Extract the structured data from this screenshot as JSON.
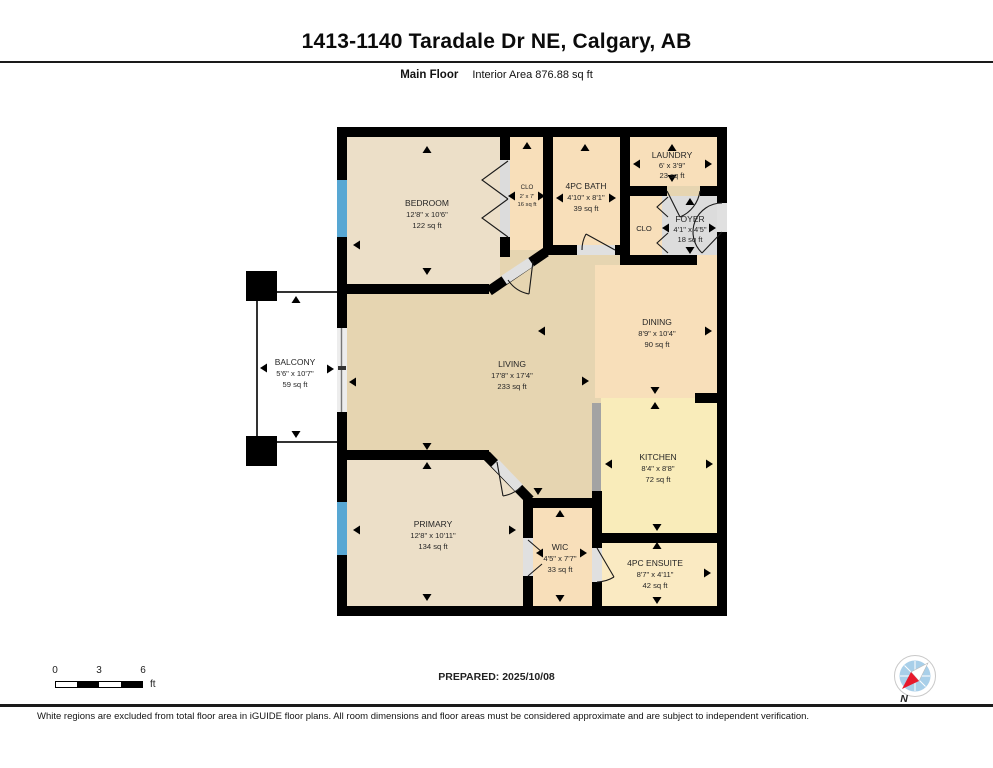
{
  "header": {
    "title": "1413-1140 Taradale Dr NE, Calgary, AB",
    "floor_label": "Main Floor",
    "area_label": "Interior Area 876.88 sq ft"
  },
  "rooms": {
    "bedroom": {
      "name": "BEDROOM",
      "dims": "12'8\" x 10'6\"",
      "area": "122 sq ft"
    },
    "clo_bedroom": {
      "name": "CLO",
      "dims": "2' x 7'",
      "area": "16 sq ft"
    },
    "bath": {
      "name": "4PC BATH",
      "dims": "4'10\" x 8'1\"",
      "area": "39 sq ft"
    },
    "laundry": {
      "name": "LAUNDRY",
      "dims": "6' x 3'9\"",
      "area": "23 sq ft"
    },
    "foyer": {
      "name": "FOYER",
      "dims": "4'1\" x 4'5\"",
      "area": "18 sq ft"
    },
    "clo_foyer": {
      "name": "CLO"
    },
    "dining": {
      "name": "DINING",
      "dims": "8'9\" x 10'4\"",
      "area": "90 sq ft"
    },
    "living": {
      "name": "LIVING",
      "dims": "17'8\" x 17'4\"",
      "area": "233 sq ft"
    },
    "kitchen": {
      "name": "KITCHEN",
      "dims": "8'4\" x 8'8\"",
      "area": "72 sq ft"
    },
    "primary": {
      "name": "PRIMARY",
      "dims": "12'8\" x 10'11\"",
      "area": "134 sq ft"
    },
    "wic": {
      "name": "WIC",
      "dims": "4'5\" x 7'7\"",
      "area": "33 sq ft"
    },
    "ensuite": {
      "name": "4PC ENSUITE",
      "dims": "8'7\" x 4'11\"",
      "area": "42 sq ft"
    },
    "balcony": {
      "name": "BALCONY",
      "dims": "5'6\" x 10'7\"",
      "area": "59 sq ft"
    }
  },
  "scale_bar": {
    "tick0": "0",
    "tick1": "3",
    "tick2": "6",
    "unit": "ft"
  },
  "prepared_label": "PREPARED: 2025/10/08",
  "compass": {
    "north_label": "N"
  },
  "footer_disclaimer": "White regions are excluded from total floor area in iGUIDE floor plans. All room dimensions and floor areas must be considered approximate and are subject to independent verification.",
  "colors": {
    "wall": "#000000",
    "window": "#58a7d3",
    "floor_living": "#e6d5b1",
    "floor_bedroom": "#ecdfc8",
    "floor_peach": "#f8dfba",
    "floor_kitchen": "#f9ecba",
    "floor_ensuite": "#faeac2",
    "floor_foyer": "#dcdcdc",
    "counter": "#a3a3a3",
    "opening": "#e0e0e0",
    "compass_blue": "#a8cfe9",
    "compass_red": "#e8192c"
  }
}
